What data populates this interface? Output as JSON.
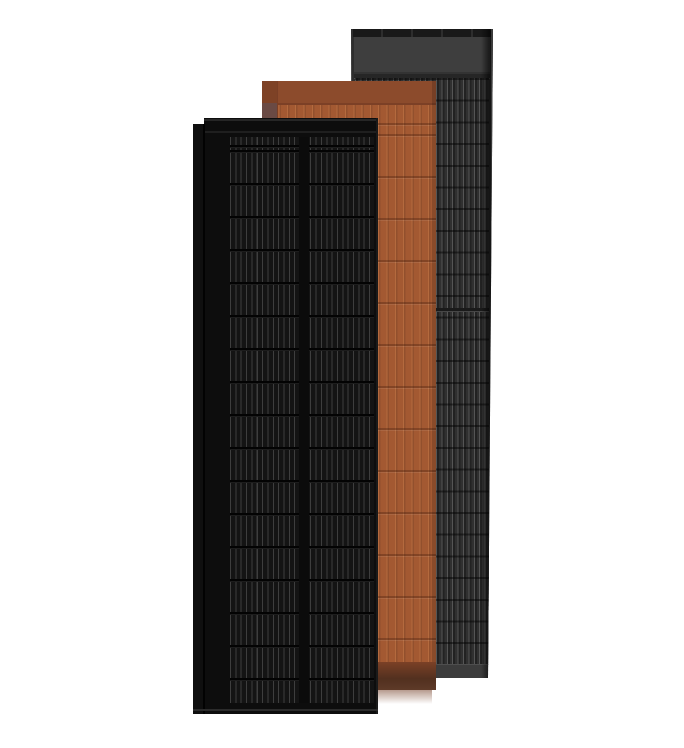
{
  "scene": {
    "description": "Product render of three overlapping vertical solar roof panels on a white background",
    "panels": [
      {
        "id": "black-panel",
        "label": "black framed solar panel, front left",
        "finish": "matte black cells with thin silver busbars"
      },
      {
        "id": "terracotta-panel",
        "label": "terracotta solar roof tile, middle",
        "finish": "orange-brown tile with vertical cell ribs"
      },
      {
        "id": "gray-panel",
        "label": "dark gray solar panel, back right",
        "finish": "charcoal striped cells with gray header band"
      }
    ],
    "colors": {
      "background": "#ffffff",
      "gray-frame": "#2e2e2e",
      "gray-cap": "#191919",
      "gray-cap-tick": "#2d2d2d",
      "gray-header": "#3e3e3e",
      "gray-header-line": "#333333",
      "gray-gap": "#262626",
      "gray-topline": "#505050",
      "gray-body": "#2a2a2a",
      "gray-stripe-light": "#555555",
      "gray-stripe-dark": "#222222",
      "gray-stripe-mid": "#303030",
      "gray-joint": "#1a1a1a",
      "gray-joint-hi": "#474747",
      "gray-edge-hi": "#3a3a3a",
      "gray-bottom": "#3c3c3c",
      "gray-bottom-hi": "#4e4e4e",
      "terra-body": "#a35932",
      "terra-header": "#8c4b2c",
      "terra-header-line": "#7c4026",
      "terra-cell-line": "#b46a3e",
      "terra-flange-line": "#7a3f26",
      "terra-flange-shadow": "#6a4a44",
      "terra-bottom-top": "#7b4126",
      "terra-bottom-dark": "#52301f",
      "terra-bottom-edge": "#5e3a28",
      "black-frame": "#0d0d0d",
      "black-top-hi": "#262626",
      "black-frame-line": "#1f1f1f",
      "black-flange": "#0f0f0f",
      "black-groove": "#020202",
      "black-cell-bg": "#141414",
      "black-busbar": "#3e3e3e",
      "black-row-line": "#030303",
      "black-row-hi": "#1d1d1d",
      "black-center-gap": "#0b0b0b",
      "black-bottom-hi": "#2b2b2b",
      "black-right-edge": "#1a1a1a"
    }
  }
}
